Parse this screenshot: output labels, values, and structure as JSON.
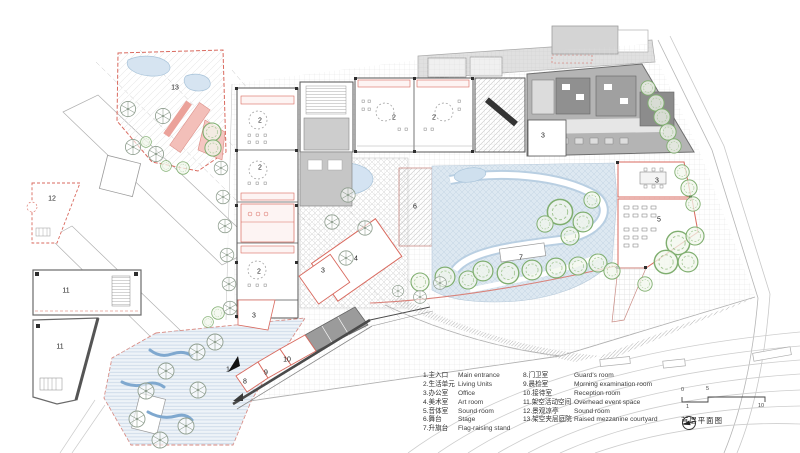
{
  "title": "首层平面图",
  "colors": {
    "boundary_red": "#d96a5f",
    "pink_fill": "#f3c0b9",
    "water_blue": "#d6e4f1",
    "track_blue": "#b9cfe2",
    "tree_green": "#7fae6f",
    "building_gray": "#b4b4b4",
    "dark_gray": "#8a8a8a",
    "line_gray": "#bbbbbb",
    "text": "#3a3a3a"
  },
  "legend": {
    "col1": [
      {
        "zh": "1.主入口",
        "en": "Main entrance"
      },
      {
        "zh": "2.生活单元",
        "en": "Living Units"
      },
      {
        "zh": "3.办公室",
        "en": "Office"
      },
      {
        "zh": "4.美术室",
        "en": "Art room"
      },
      {
        "zh": "5.音体室",
        "en": "Sound room"
      },
      {
        "zh": "6.舞台",
        "en": "Stage"
      },
      {
        "zh": "7.升旗台",
        "en": "Flag-raising stand"
      }
    ],
    "col2": [
      {
        "zh": "8.门卫室",
        "en": "Guard's room"
      },
      {
        "zh": "9.晨检室",
        "en": "Morning examination room"
      },
      {
        "zh": "10.接待室",
        "en": "Reception room"
      },
      {
        "zh": "11.架空活动空间",
        "en": "Overhead event space"
      },
      {
        "zh": "12.景观凉亭",
        "en": "Sound room"
      },
      {
        "zh": "13.架空夹层庭院",
        "en": "Raised mezzanine courtyard"
      }
    ]
  },
  "scale_bar": {
    "labels": [
      "0",
      "5",
      "1",
      "10"
    ]
  },
  "plan_labels": [
    {
      "t": "13",
      "x": 175,
      "y": 88
    },
    {
      "t": "12",
      "x": 52,
      "y": 199
    },
    {
      "t": "11",
      "x": 66,
      "y": 291
    },
    {
      "t": "11",
      "x": 60,
      "y": 347
    },
    {
      "t": "2",
      "x": 260,
      "y": 121
    },
    {
      "t": "2",
      "x": 394,
      "y": 118
    },
    {
      "t": "2",
      "x": 434,
      "y": 118
    },
    {
      "t": "2",
      "x": 260,
      "y": 168
    },
    {
      "t": "2",
      "x": 259,
      "y": 272
    },
    {
      "t": "3",
      "x": 543,
      "y": 136
    },
    {
      "t": "3",
      "x": 657,
      "y": 181
    },
    {
      "t": "5",
      "x": 659,
      "y": 220
    },
    {
      "t": "6",
      "x": 415,
      "y": 207
    },
    {
      "t": "7",
      "x": 521,
      "y": 258
    },
    {
      "t": "4",
      "x": 356,
      "y": 259
    },
    {
      "t": "3",
      "x": 323,
      "y": 271
    },
    {
      "t": "3",
      "x": 254,
      "y": 316
    },
    {
      "t": "10",
      "x": 287,
      "y": 360
    },
    {
      "t": "9",
      "x": 266,
      "y": 373
    },
    {
      "t": "8",
      "x": 245,
      "y": 382
    },
    {
      "t": "1",
      "x": 228,
      "y": 370
    }
  ]
}
